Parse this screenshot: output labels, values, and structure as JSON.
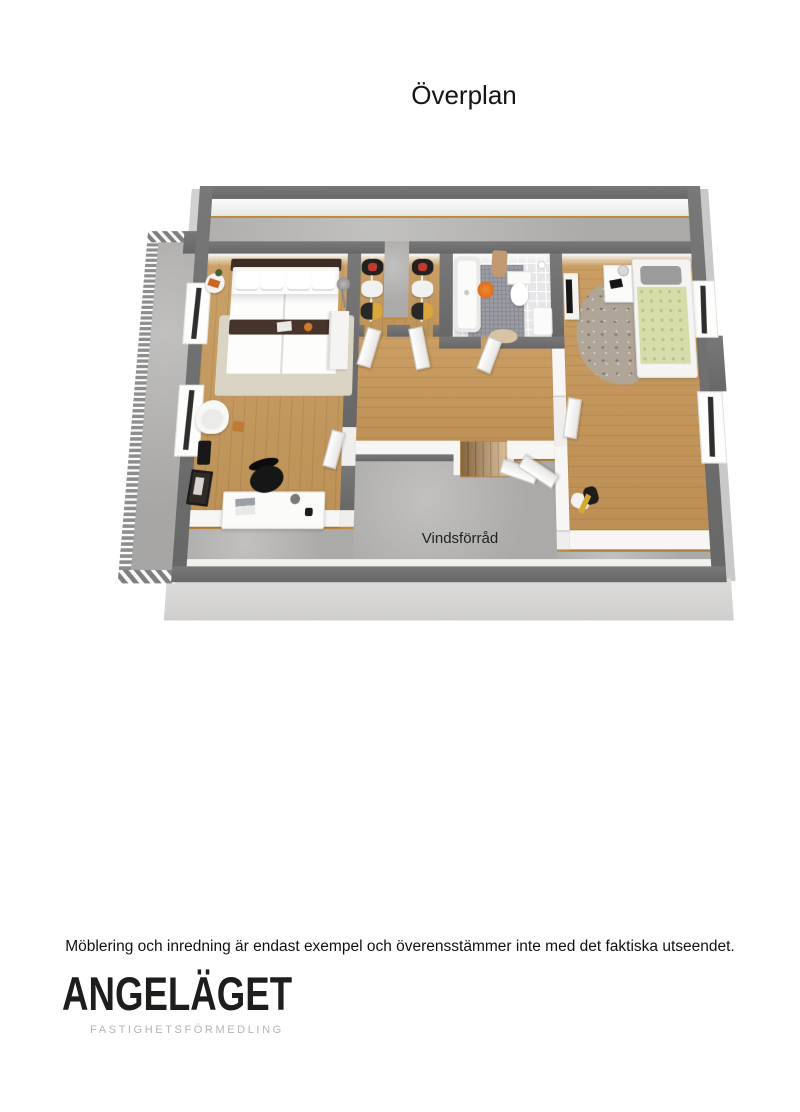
{
  "header": {
    "title": "Överplan"
  },
  "plan": {
    "storage_label": "Vindsförråd"
  },
  "footer": {
    "disclaimer": "Möblering och inredning är endast exempel och överensstämmer inte med det faktiska utseendet.",
    "logo": {
      "name": "ANGELÄGET",
      "tagline": "FASTIGHETSFÖRMEDLING"
    }
  },
  "colors": {
    "wall_dark": "#6e6e6e",
    "wall_side_face": "#d3d3d3",
    "wood_floor": "#c79a5c",
    "concrete_floor": "#b4b3b1",
    "floor_trim": "#bd8a42",
    "accent_orange": "#e0721e",
    "duvet_green": "#d7dcab",
    "bed_frame_brown": "#46332a",
    "rug_beige": "#d9d4c4",
    "logo_black": "#1d1d1b",
    "logo_gray": "#b4b4b4"
  }
}
